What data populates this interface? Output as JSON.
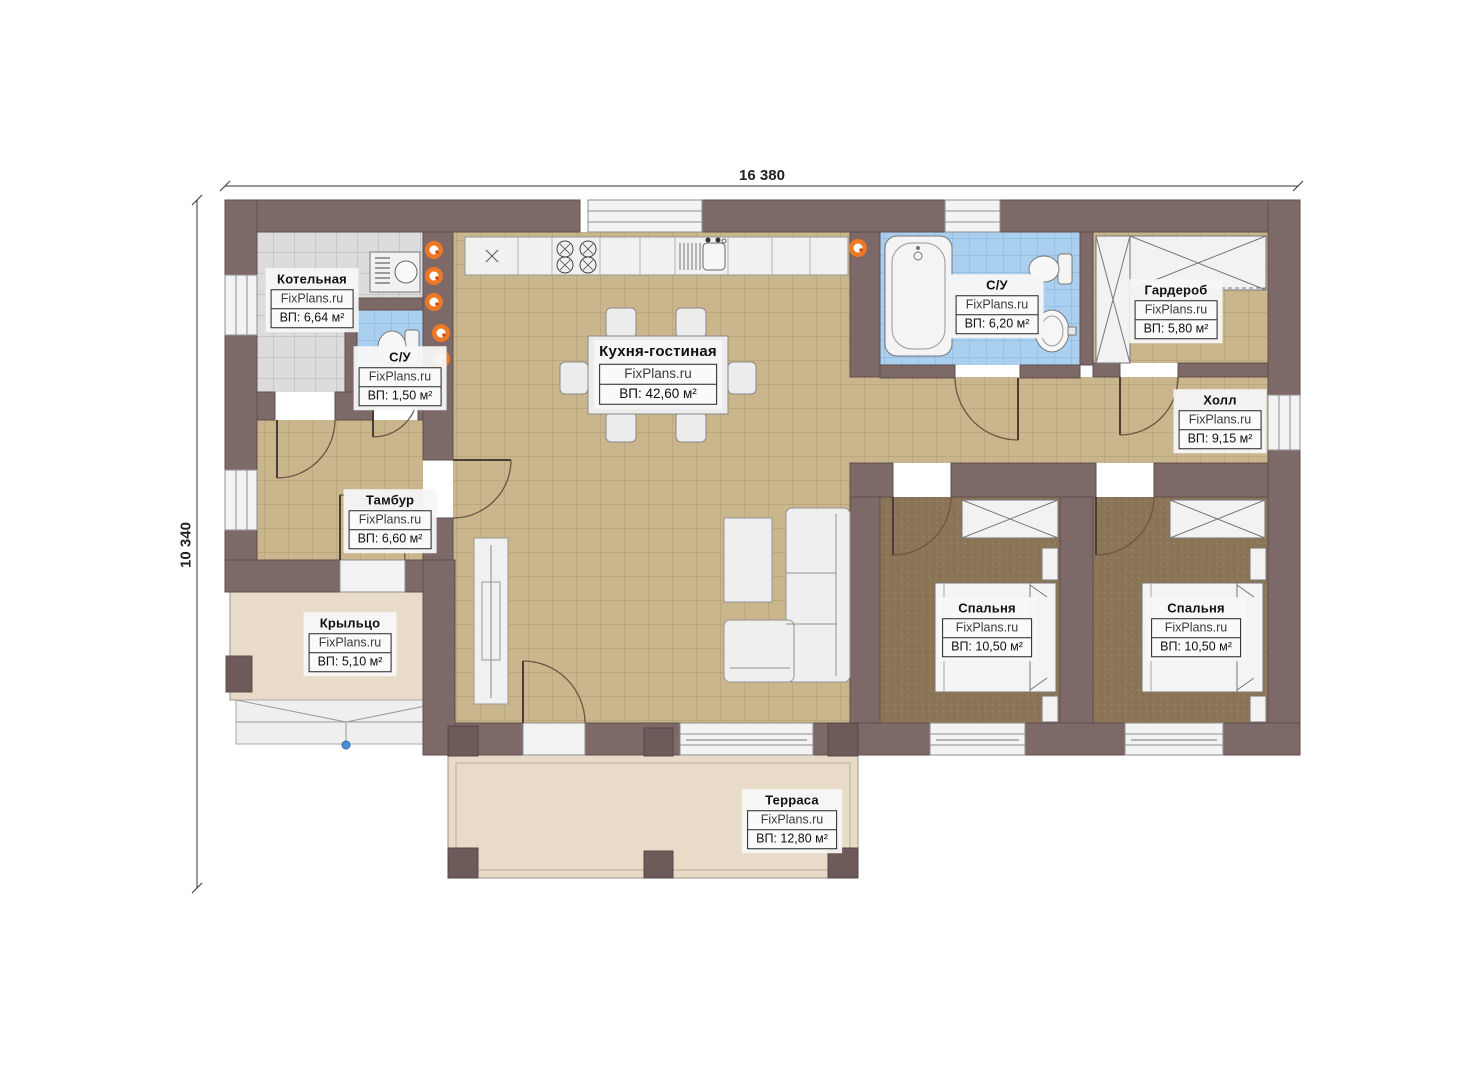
{
  "dimensions": {
    "width_label": "16 380",
    "height_label": "10 340"
  },
  "rooms": [
    {
      "id": "boiler",
      "name": "Котельная",
      "brand": "FixPlans.ru",
      "area": "ВП: 6,64 м²"
    },
    {
      "id": "wc-small",
      "name": "С/У",
      "brand": "FixPlans.ru",
      "area": "ВП: 1,50 м²"
    },
    {
      "id": "kitchen-living",
      "name": "Кухня-гостиная",
      "brand": "FixPlans.ru",
      "area": "ВП: 42,60 м²"
    },
    {
      "id": "bathroom",
      "name": "С/У",
      "brand": "FixPlans.ru",
      "area": "ВП: 6,20 м²"
    },
    {
      "id": "wardrobe",
      "name": "Гардероб",
      "brand": "FixPlans.ru",
      "area": "ВП: 5,80 м²"
    },
    {
      "id": "hall",
      "name": "Холл",
      "brand": "FixPlans.ru",
      "area": "ВП: 9,15 м²"
    },
    {
      "id": "vestibule",
      "name": "Тамбур",
      "brand": "FixPlans.ru",
      "area": "ВП: 6,60 м²"
    },
    {
      "id": "porch",
      "name": "Крыльцо",
      "brand": "FixPlans.ru",
      "area": "ВП: 5,10 м²"
    },
    {
      "id": "bedroom-1",
      "name": "Спальня",
      "brand": "FixPlans.ru",
      "area": "ВП: 10,50 м²"
    },
    {
      "id": "bedroom-2",
      "name": "Спальня",
      "brand": "FixPlans.ru",
      "area": "ВП: 10,50 м²"
    },
    {
      "id": "terrace",
      "name": "Терраса",
      "brand": "FixPlans.ru",
      "area": "ВП: 12,80 м²"
    }
  ],
  "colors": {
    "wall": "#7d6968",
    "post": "#6e5a59",
    "floor_tile_tan": "#cab68c",
    "floor_tile_gray": "#dcdcdc",
    "floor_tile_blue": "#abcfee",
    "floor_bedroom": "#8d7657",
    "floor_outdoor": "#e8dcc8",
    "fixture_white": "#f1f1f1",
    "riser_orange": "#f97a1e",
    "step_marker_blue": "#4a90d9"
  }
}
